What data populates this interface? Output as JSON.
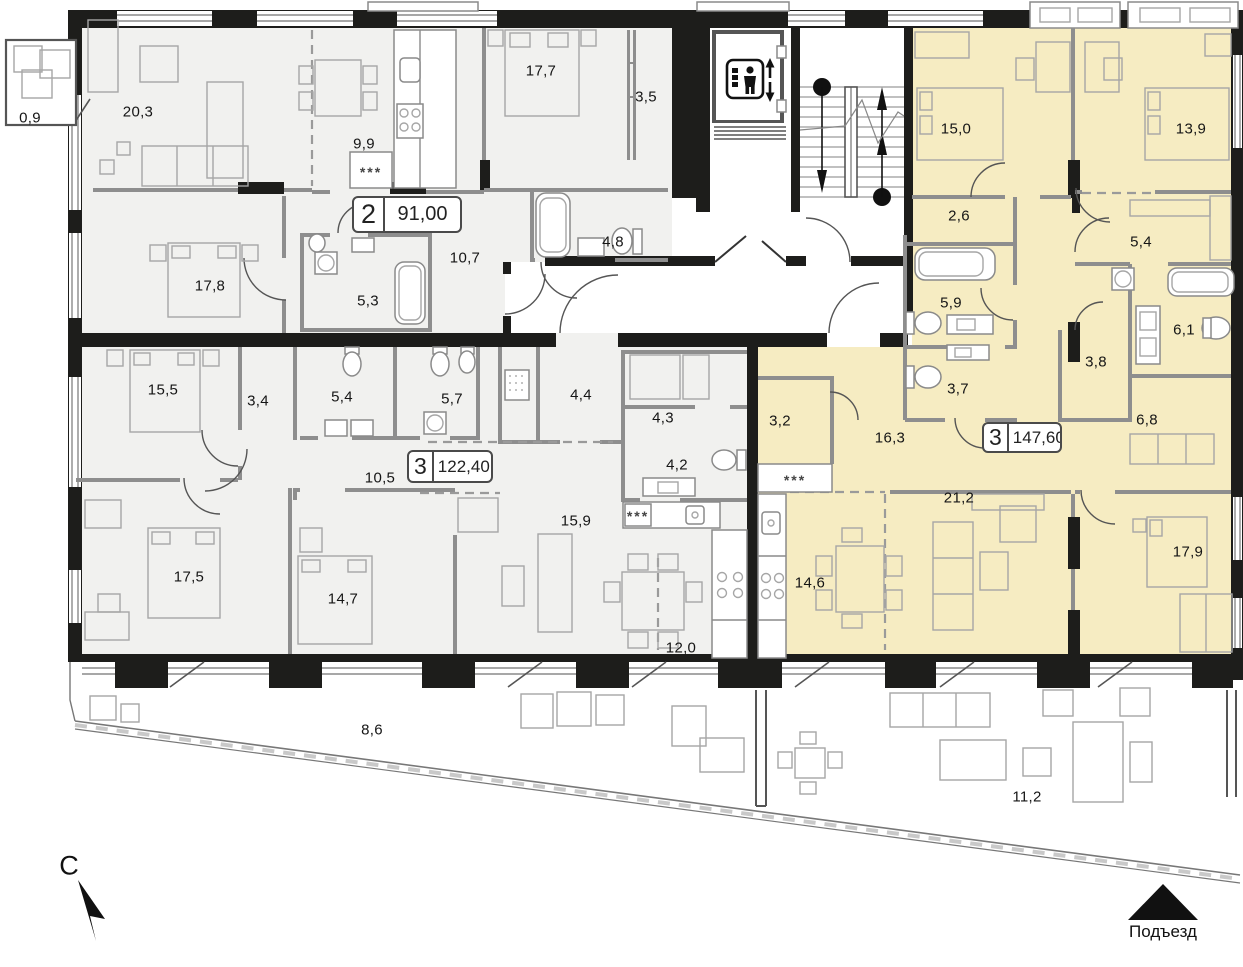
{
  "north": {
    "label": "С"
  },
  "entrance": {
    "label": "Подъезд"
  },
  "apartments": [
    {
      "rooms": "2",
      "area": "91,00"
    },
    {
      "rooms": "3",
      "area": "122,40"
    },
    {
      "rooms": "3",
      "area": "147,60"
    }
  ],
  "kitchen_marks": [
    "***",
    "***",
    "***"
  ],
  "room_areas": [
    {
      "name": "balcony",
      "area": "0,9"
    },
    {
      "name": "living-room",
      "area": "20,3"
    },
    {
      "name": "kitchen",
      "area": "9,9"
    },
    {
      "name": "bedroom",
      "area": "17,7"
    },
    {
      "name": "wardrobe",
      "area": "3,5"
    },
    {
      "name": "bedroom",
      "area": "17,8"
    },
    {
      "name": "hallway",
      "area": "10,7"
    },
    {
      "name": "bathroom",
      "area": "4,8"
    },
    {
      "name": "bathroom",
      "area": "5,3"
    },
    {
      "name": "bedroom",
      "area": "15,0"
    },
    {
      "name": "bedroom",
      "area": "13,9"
    },
    {
      "name": "wardrobe",
      "area": "2,6"
    },
    {
      "name": "hallway",
      "area": "5,4"
    },
    {
      "name": "bathroom",
      "area": "5,9"
    },
    {
      "name": "bathroom",
      "area": "6,1"
    },
    {
      "name": "storage",
      "area": "3,8"
    },
    {
      "name": "wc",
      "area": "3,7"
    },
    {
      "name": "room",
      "area": "6,8"
    },
    {
      "name": "bedroom",
      "area": "15,5"
    },
    {
      "name": "wardrobe",
      "area": "3,4"
    },
    {
      "name": "bathroom",
      "area": "5,4"
    },
    {
      "name": "bathroom",
      "area": "5,7"
    },
    {
      "name": "laundry",
      "area": "4,4"
    },
    {
      "name": "storage",
      "area": "4,3"
    },
    {
      "name": "kitchen-niche",
      "area": "3,2"
    },
    {
      "name": "hallway",
      "area": "16,3"
    },
    {
      "name": "corridor",
      "area": "10,5"
    },
    {
      "name": "wc",
      "area": "4,2"
    },
    {
      "name": "living-room",
      "area": "21,2"
    },
    {
      "name": "living-room",
      "area": "15,9"
    },
    {
      "name": "bedroom",
      "area": "17,5"
    },
    {
      "name": "bedroom",
      "area": "14,7"
    },
    {
      "name": "kitchen-dining",
      "area": "14,6"
    },
    {
      "name": "bedroom",
      "area": "17,9"
    },
    {
      "name": "dining",
      "area": "12,0"
    },
    {
      "name": "terrace",
      "area": "8,6"
    },
    {
      "name": "terrace",
      "area": "11,2"
    }
  ],
  "colors": {
    "highlight": "#f6ecc2",
    "neutral": "#f1f1ef",
    "wall": "#1d1d1b",
    "partition": "#8e8e8e"
  }
}
